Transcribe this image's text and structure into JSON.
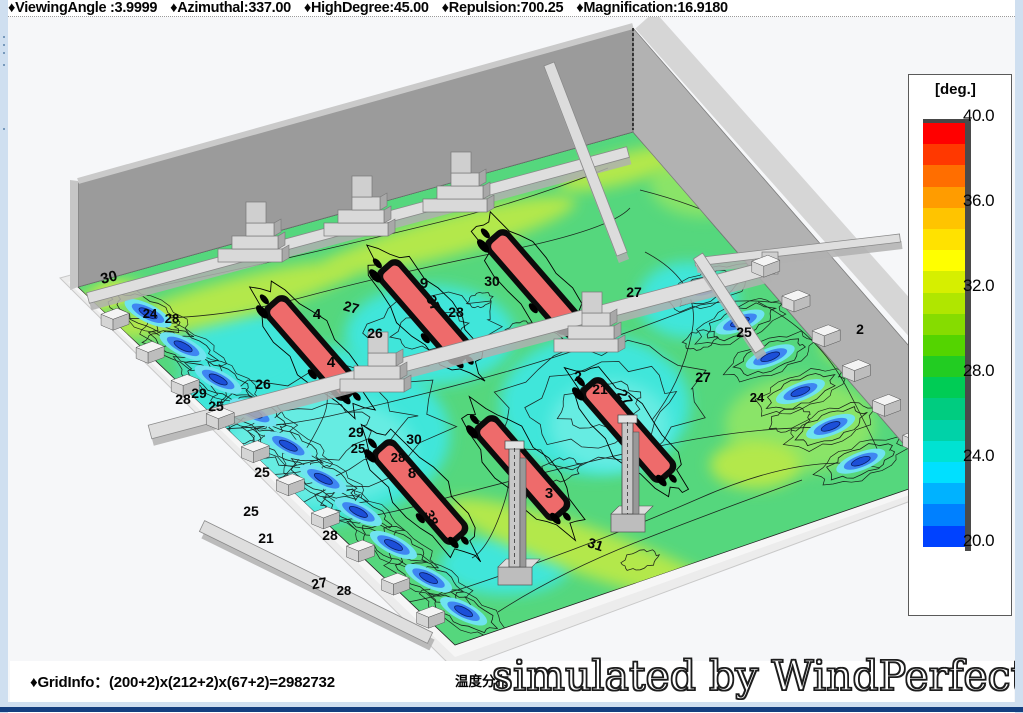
{
  "toolbar": {
    "items": [
      "♦ViewingAngle :3.9999",
      "♦Azimuthal:337.00",
      "♦HighDegree:45.00",
      "♦Repulsion:700.25",
      "♦Magnification:16.9180"
    ]
  },
  "statusbar": {
    "gridinfo": "♦GridInfo：(200+2)x(212+2)x(67+2)=2982732",
    "caption": "温度分布",
    "watermark": "simulated by WindPerfectDX"
  },
  "legend": {
    "title": "[deg.]",
    "unit": "deg",
    "max": 40.0,
    "min": 20.0,
    "ticks": [
      "40.0",
      "36.0",
      "32.0",
      "28.0",
      "24.0",
      "20.0"
    ],
    "band_colors": [
      "#ff0000",
      "#ff3800",
      "#ff6e00",
      "#ff9c00",
      "#ffc400",
      "#ffe200",
      "#ffff00",
      "#d6ef00",
      "#b0e600",
      "#86dc00",
      "#54d400",
      "#22cc22",
      "#00cc55",
      "#00cc80",
      "#00d2a8",
      "#00e2d2",
      "#00e0ff",
      "#00b2ff",
      "#0080ff",
      "#0042ff"
    ]
  },
  "palette": {
    "floor_green": "#55d77d",
    "floor_cyan": "#3fe6da",
    "floor_yellow_green": "#b3e84b",
    "rack_hot_red": "#ee6b6b",
    "cold_pool_blue": "#1c4fd8",
    "wall_gray": "#9b9b9b",
    "duct_gray": "#dedede",
    "frame_blue": "#cfdff0",
    "frame_navy": "#143f80"
  },
  "contour_labels": [
    {
      "t": "30",
      "x": 110,
      "y": 282,
      "r": -14,
      "s": 15
    },
    {
      "t": "24",
      "x": 150,
      "y": 318,
      "r": 0,
      "s": 13
    },
    {
      "t": "28",
      "x": 172,
      "y": 323,
      "r": 0,
      "s": 13
    },
    {
      "t": "28",
      "x": 183,
      "y": 404,
      "r": 0,
      "s": 14
    },
    {
      "t": "29",
      "x": 199,
      "y": 398,
      "r": 0,
      "s": 14
    },
    {
      "t": "25",
      "x": 216,
      "y": 411,
      "r": 0,
      "s": 14
    },
    {
      "t": "26",
      "x": 263,
      "y": 389,
      "r": 0,
      "s": 14
    },
    {
      "t": "26",
      "x": 375,
      "y": 338,
      "r": 0,
      "s": 14
    },
    {
      "t": "25",
      "x": 262,
      "y": 477,
      "r": 0,
      "s": 14
    },
    {
      "t": "25",
      "x": 251,
      "y": 516,
      "r": 0,
      "s": 14
    },
    {
      "t": "21",
      "x": 266,
      "y": 543,
      "r": 0,
      "s": 14
    },
    {
      "t": "28",
      "x": 330,
      "y": 540,
      "r": 0,
      "s": 14
    },
    {
      "t": "27",
      "x": 320,
      "y": 588,
      "r": -10,
      "s": 14
    },
    {
      "t": "28",
      "x": 344,
      "y": 595,
      "r": 0,
      "s": 13
    },
    {
      "t": "4",
      "x": 317,
      "y": 319,
      "r": 0,
      "s": 15
    },
    {
      "t": "27",
      "x": 350,
      "y": 312,
      "r": 15,
      "s": 14
    },
    {
      "t": "4",
      "x": 331,
      "y": 367,
      "r": 0,
      "s": 15
    },
    {
      "t": "9",
      "x": 424,
      "y": 288,
      "r": 0,
      "s": 15
    },
    {
      "t": "37",
      "x": 429,
      "y": 305,
      "r": 65,
      "s": 14
    },
    {
      "t": "28",
      "x": 456,
      "y": 317,
      "r": 0,
      "s": 14
    },
    {
      "t": "30",
      "x": 492,
      "y": 286,
      "r": 0,
      "s": 14
    },
    {
      "t": "29",
      "x": 356,
      "y": 437,
      "r": 0,
      "s": 14
    },
    {
      "t": "30",
      "x": 414,
      "y": 444,
      "r": 0,
      "s": 14
    },
    {
      "t": "25",
      "x": 358,
      "y": 453,
      "r": 0,
      "s": 13
    },
    {
      "t": "28",
      "x": 398,
      "y": 462,
      "r": 0,
      "s": 13
    },
    {
      "t": "8",
      "x": 412,
      "y": 478,
      "r": 0,
      "s": 15
    },
    {
      "t": "38",
      "x": 427,
      "y": 520,
      "r": 65,
      "s": 14
    },
    {
      "t": "3",
      "x": 549,
      "y": 498,
      "r": 0,
      "s": 15
    },
    {
      "t": "31",
      "x": 594,
      "y": 549,
      "r": 18,
      "s": 14
    },
    {
      "t": "27",
      "x": 634,
      "y": 297,
      "r": 0,
      "s": 14
    },
    {
      "t": "27",
      "x": 703,
      "y": 382,
      "r": 0,
      "s": 14
    },
    {
      "t": "25",
      "x": 744,
      "y": 337,
      "r": 0,
      "s": 14
    },
    {
      "t": "24",
      "x": 757,
      "y": 402,
      "r": 0,
      "s": 13
    },
    {
      "t": "2",
      "x": 860,
      "y": 334,
      "r": 0,
      "s": 14
    },
    {
      "t": "21",
      "x": 600,
      "y": 394,
      "r": 0,
      "s": 14
    },
    {
      "t": "27",
      "x": 621,
      "y": 400,
      "r": 55,
      "s": 14
    },
    {
      "t": "2",
      "x": 578,
      "y": 381,
      "r": 0,
      "s": 14
    }
  ]
}
